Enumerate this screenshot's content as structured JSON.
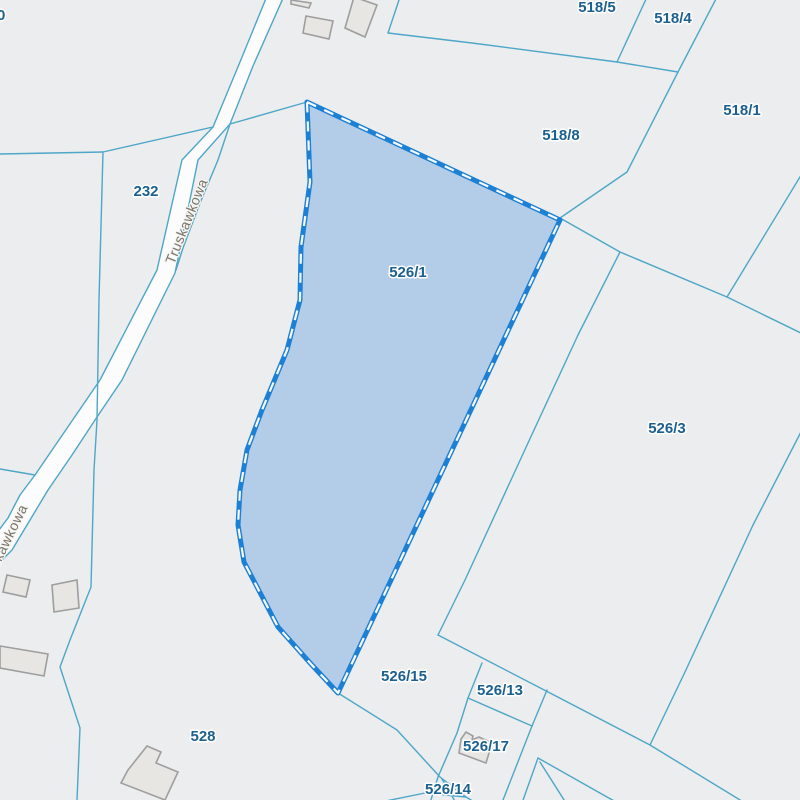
{
  "map": {
    "type": "cadastral-parcel-map",
    "street_name": "Truskawkowa",
    "selected_parcel_id": "526/1",
    "parcel_labels": [
      {
        "text": "0"
      },
      {
        "text": "518/5"
      },
      {
        "text": "518/4"
      },
      {
        "text": "518/1"
      },
      {
        "text": "518/8"
      },
      {
        "text": "232"
      },
      {
        "text": "526/1"
      },
      {
        "text": "526/3"
      },
      {
        "text": "526/15"
      },
      {
        "text": "526/13"
      },
      {
        "text": "526/17"
      },
      {
        "text": "526/14"
      },
      {
        "text": "528"
      }
    ],
    "road_labels": [
      {
        "text": "Truskawkowa"
      },
      {
        "text": "Truskawkowa"
      }
    ],
    "colors": {
      "background": "#ebedee",
      "parcel_boundary": "#4ea6c8",
      "selection_stroke": "#1c80d4",
      "selection_dash": "#f6fafd",
      "selection_fill": "#b3cce8",
      "parcel_label": "#1c6090",
      "road_label": "#7c7467",
      "road_fill": "#fcfcfd",
      "building_fill": "#e8e6e3",
      "building_stroke": "#9e9e9e"
    }
  }
}
